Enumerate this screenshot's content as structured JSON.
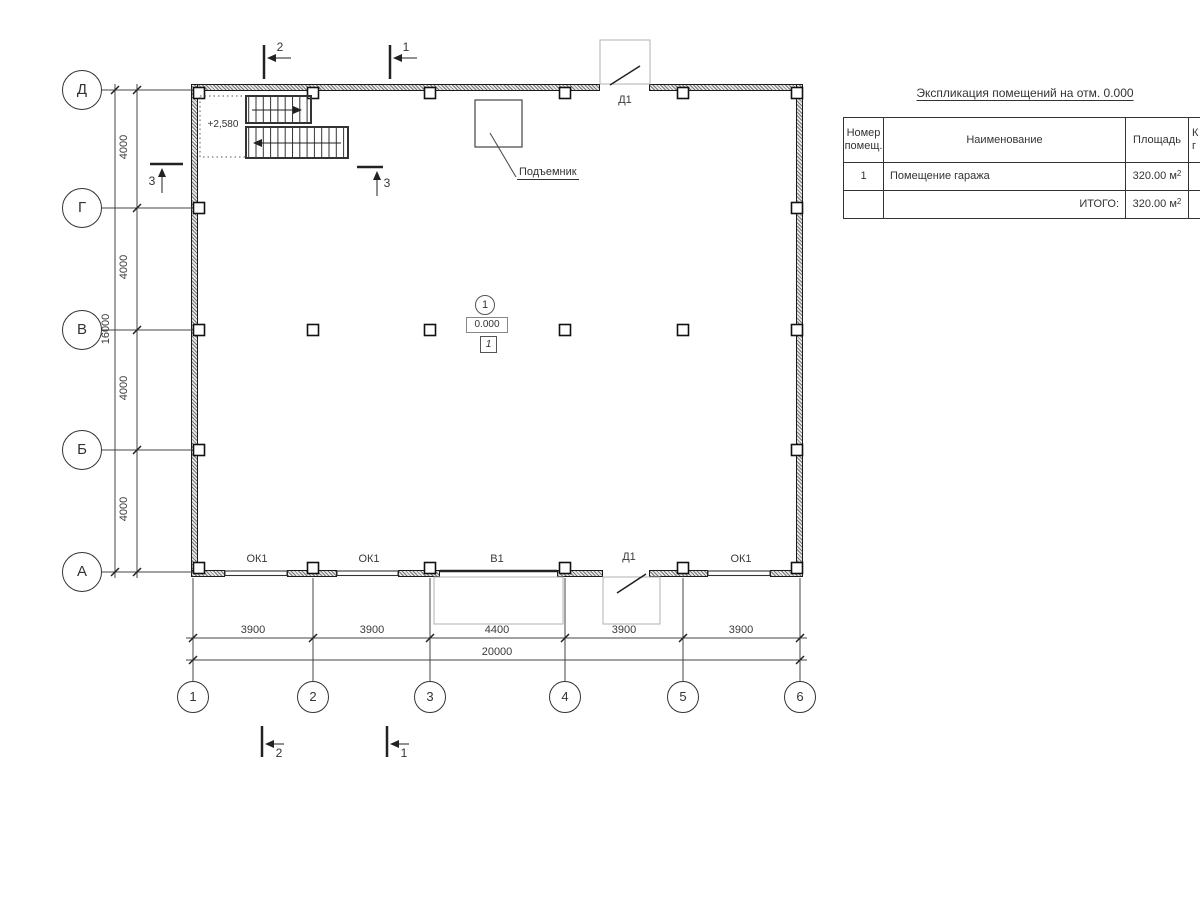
{
  "title": "Экспликация помещений на отм. 0.000",
  "table": {
    "h_num": "Номер помещ.",
    "h_name": "Наименование",
    "h_area": "Площадь",
    "h_extra1": "К",
    "h_extra2": "г",
    "rows": [
      {
        "num": "1",
        "name": "Помещение гаража",
        "area": "320.00 м",
        "sup": "2"
      },
      {
        "total_label": "ИТОГО:",
        "area": "320.00 м",
        "sup": "2"
      }
    ]
  },
  "grid": {
    "rows": [
      "Д",
      "Г",
      "В",
      "Б",
      "А"
    ],
    "cols": [
      "1",
      "2",
      "3",
      "4",
      "5",
      "6"
    ]
  },
  "dims": {
    "h": [
      "3900",
      "3900",
      "4400",
      "3900",
      "3900"
    ],
    "h_total": "20000",
    "v": [
      "4000",
      "4000",
      "4000",
      "4000"
    ],
    "v_total": "16000"
  },
  "sections": {
    "s1": "1",
    "s2": "2",
    "s3": "3"
  },
  "labels": {
    "lift": "Подъемник",
    "landing_level": "+2,580",
    "room_number": "1",
    "room_level": "0.000",
    "room_box": "1",
    "door": "Д1",
    "gate": "В1",
    "window": "ОК1"
  }
}
